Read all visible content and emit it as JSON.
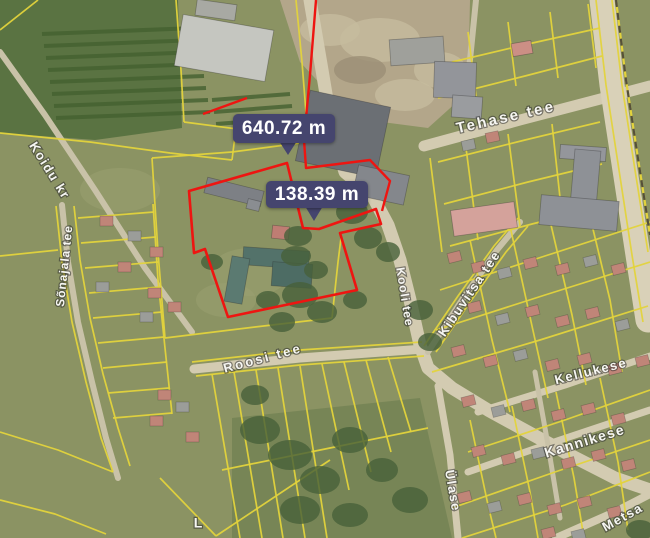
{
  "map": {
    "palette": {
      "base": "#8b9363",
      "fieldDark": "#5a7342",
      "fieldRow": "#446030",
      "dirt": "#b3a68a",
      "dirtLight": "#c6bb9d",
      "dirtDark": "#9b8f75",
      "woods": "#5f7647",
      "tree": "#47603a",
      "grassLight": "#9aa171",
      "road": "#d3cbb1",
      "roadMinor": "#c9c2a8",
      "highway": "#d9d1b8",
      "yellow": "#e3d33c",
      "dashDark": "#55503a",
      "red": "#ee1511",
      "badge": "#45456e",
      "salmon": "#c08578",
      "grayHouse": "#9b9d99"
    },
    "measurements": [
      {
        "label": "640.72 m",
        "x": 233,
        "y": 114,
        "w": 102,
        "h": 29,
        "tail": "279,141 297,141 288,155"
      },
      {
        "label": "138.39 m",
        "x": 266,
        "y": 181,
        "w": 102,
        "h": 27,
        "tail": "305,206 323,206 314,221"
      }
    ],
    "street_labels": [
      {
        "id": "tehase-tee",
        "text": "Tehase tee",
        "x": 506,
        "y": 118,
        "rotate": -13,
        "size": 15,
        "spacing": 2.5
      },
      {
        "id": "koidu-kr",
        "text": "Koidu kr",
        "x": 49,
        "y": 171,
        "rotate": 58,
        "size": 13,
        "spacing": 1.5
      },
      {
        "id": "sonajala-tee",
        "text": "Sõnajala tee",
        "x": 65,
        "y": 266,
        "rotate": -84,
        "size": 12,
        "spacing": 1
      },
      {
        "id": "roosi-tee",
        "text": "Roosi tee",
        "x": 263,
        "y": 359,
        "rotate": -15,
        "size": 13,
        "spacing": 2.5
      },
      {
        "id": "kooli-tee",
        "text": "Kooli tee",
        "x": 404,
        "y": 297,
        "rotate": 81,
        "size": 12,
        "spacing": 1
      },
      {
        "id": "kibuvitsa-tee",
        "text": "Kibuvitsa tee",
        "x": 470,
        "y": 294,
        "rotate": -56,
        "size": 13,
        "spacing": 1.5
      },
      {
        "id": "kellukese",
        "text": "Kellukese",
        "x": 591,
        "y": 372,
        "rotate": -14,
        "size": 13,
        "spacing": 1.5
      },
      {
        "id": "kannikese",
        "text": "Kannikese",
        "x": 585,
        "y": 442,
        "rotate": -17,
        "size": 14,
        "spacing": 1.5
      },
      {
        "id": "ulase",
        "text": "Ülase",
        "x": 452,
        "y": 491,
        "rotate": 80,
        "size": 13,
        "spacing": 1.5
      },
      {
        "id": "metsa",
        "text": "Metsa",
        "x": 623,
        "y": 518,
        "rotate": -29,
        "size": 13,
        "spacing": 1.5
      },
      {
        "id": "partial-l",
        "text": "L",
        "x": 198,
        "y": 524,
        "rotate": 0,
        "size": 14,
        "spacing": 0
      }
    ],
    "red_outline": {
      "polygon": "189,191 287,163 303,228 319,229 376,209 381,224 340,233 357,290 228,317 205,249 194,253",
      "lines": [
        "316,0 310,75 304,140 306,168 370,160 390,181 382,211",
        "203,114 247,98"
      ]
    },
    "terrain": {
      "field_polygon": "0,0 178,0 182,128 95,140 0,133",
      "field_rows": [
        "42,34 196,28",
        "44,46 198,40",
        "46,58 200,52",
        "48,70 202,64",
        "50,82 204,76",
        "52,94 206,88",
        "54,106 208,100",
        "56,118 210,112",
        "212,100 290,94",
        "214,112 292,106",
        "216,124 294,118"
      ],
      "dirt_polygon": "280,0 470,0 468,92 428,128 352,118 300,62",
      "dirt_blobs": [
        [
          380,
          40,
          40,
          22
        ],
        [
          330,
          30,
          30,
          16
        ],
        [
          440,
          70,
          26,
          18
        ],
        [
          405,
          95,
          30,
          16
        ]
      ],
      "dirt_dark_blobs": [
        [
          360,
          70,
          26,
          14
        ]
      ],
      "woods_polygon": "232,418 420,398 452,538 232,538",
      "grass_patches": [
        [
          250,
          272,
          40,
          24
        ],
        [
          226,
          300,
          30,
          17
        ],
        [
          120,
          190,
          40,
          22
        ]
      ],
      "trees": [
        [
          352,
          212,
          16,
          12
        ],
        [
          368,
          238,
          14,
          11
        ],
        [
          336,
          192,
          13,
          10
        ],
        [
          388,
          252,
          12,
          10
        ],
        [
          300,
          295,
          18,
          13
        ],
        [
          322,
          312,
          15,
          11
        ],
        [
          282,
          322,
          13,
          10
        ],
        [
          355,
          300,
          12,
          9
        ],
        [
          298,
          236,
          14,
          10
        ],
        [
          268,
          300,
          12,
          9
        ],
        [
          420,
          310,
          13,
          10
        ],
        [
          430,
          342,
          12,
          9
        ],
        [
          260,
          430,
          20,
          14
        ],
        [
          290,
          455,
          22,
          15
        ],
        [
          320,
          480,
          20,
          14
        ],
        [
          350,
          440,
          18,
          13
        ],
        [
          382,
          470,
          16,
          12
        ],
        [
          410,
          500,
          18,
          13
        ],
        [
          300,
          510,
          20,
          14
        ],
        [
          350,
          515,
          18,
          12
        ],
        [
          255,
          395,
          14,
          10
        ],
        [
          640,
          530,
          14,
          10
        ],
        [
          212,
          262,
          11,
          8
        ],
        [
          296,
          256,
          15,
          10
        ],
        [
          316,
          270,
          12,
          9
        ]
      ]
    },
    "roads": [
      {
        "pts": "310,0 322,70 332,130 345,172 372,195 388,225 400,260 410,300 420,345 428,368 452,388 488,410 528,432 570,455 615,478 650,490",
        "w": 13,
        "c": "road"
      },
      {
        "pts": "424,146 520,120 650,86",
        "w": 11,
        "c": "road"
      },
      {
        "pts": "194,369 300,358 424,349",
        "w": 9,
        "c": "road"
      },
      {
        "pts": "0,52 45,115 95,190 145,268 192,332",
        "w": 6,
        "c": "roadMinor"
      },
      {
        "pts": "62,205 68,262 78,322 92,382 106,438 118,478",
        "w": 6,
        "c": "roadMinor"
      },
      {
        "pts": "602,0 612,85 625,170 638,255 648,320",
        "w": 25,
        "c": "highway"
      },
      {
        "pts": "478,412 565,385 650,356",
        "w": 7,
        "c": "road"
      },
      {
        "pts": "468,472 560,440 650,410",
        "w": 7,
        "c": "road"
      },
      {
        "pts": "556,538 615,512 650,494",
        "w": 8,
        "c": "road"
      },
      {
        "pts": "438,386 450,455 458,538",
        "w": 7,
        "c": "road"
      },
      {
        "pts": "535,372 548,445 560,518",
        "w": 5,
        "c": "roadMinor"
      },
      {
        "pts": "428,352 462,300 497,250 520,222",
        "w": 6,
        "c": "roadMinor"
      },
      {
        "pts": "476,0 470,60 463,112",
        "w": 6,
        "c": "roadMinor"
      }
    ],
    "parcel_lines": [
      "0,30 38,0",
      "0,133 90,142 170,153 232,160",
      "176,0 181,70 184,122",
      "184,122 245,130 308,138",
      "296,0 302,62 308,138",
      "232,160 236,128",
      "152,158 158,252 165,338",
      "152,158 232,152",
      "232,152 300,143",
      "165,338 255,327 332,318",
      "332,318 338,262 341,238",
      "192,362 300,350 422,342",
      "196,376 300,365 424,356",
      "212,374 240,538",
      "234,372 262,538",
      "256,370 283,538",
      "278,368 305,538",
      "300,366 327,538",
      "322,364 349,490",
      "344,362 371,472",
      "366,360 391,452",
      "388,357 411,432",
      "222,470 330,448 428,428",
      "160,478 216,536",
      "216,536 330,460",
      "56,206 62,262 72,322 86,382 101,438 113,472",
      "74,206 80,260 90,318 103,374 118,428 130,466",
      "153,204 158,280 165,348 172,414",
      "78,218 154,212",
      "81,243 156,237",
      "85,268 158,262",
      "89,293 160,287",
      "93,318 162,312",
      "98,343 164,337",
      "103,368 167,362",
      "108,393 169,388",
      "113,418 172,413",
      "0,256 58,250",
      "0,432 58,450 113,472",
      "0,500 55,514 106,534",
      "452,62 528,44 600,28",
      "438,98 525,76 602,56",
      "468,32 476,96",
      "508,22 516,86",
      "550,12 558,78",
      "588,4 596,68",
      "438,162 525,140 600,122",
      "444,204 528,182 602,164",
      "450,246 532,224 604,206",
      "466,148 478,240",
      "508,134 520,226",
      "552,124 562,216",
      "430,158 442,252",
      "596,0 606,85 619,170 632,255 643,322",
      "612,0 622,85 635,170 648,252",
      "432,372 540,340 648,306",
      "436,330 545,295 650,262",
      "440,290 548,255 650,222",
      "468,452 565,420 650,390",
      "452,508 555,472 650,440",
      "462,538 565,505 650,472",
      "470,240 492,340 510,412",
      "510,226 532,326 548,398",
      "548,212 572,315 586,385",
      "586,200 610,300 622,372",
      "470,420 488,505 496,538",
      "512,406 530,492 538,538",
      "556,392 574,478 584,538",
      "600,378 618,462 628,530",
      "424,346 458,296 494,246 518,218",
      "436,352 470,302 506,252 528,226"
    ],
    "railway_dash": "616,0 626,80 639,165 650,235",
    "buildings": [
      {
        "x": 196,
        "y": 2,
        "w": 40,
        "h": 16,
        "r": 8,
        "f": "#a8a9a3"
      },
      {
        "x": 178,
        "y": 22,
        "w": 92,
        "h": 52,
        "r": 10,
        "f": "#c5c6c0"
      },
      {
        "x": 302,
        "y": 98,
        "w": 82,
        "h": 72,
        "r": 12,
        "f": "#6b6f74"
      },
      {
        "x": 355,
        "y": 170,
        "w": 52,
        "h": 30,
        "r": 12,
        "f": "#84878c"
      },
      {
        "x": 390,
        "y": 38,
        "w": 54,
        "h": 26,
        "r": -4,
        "f": "#9fa09b"
      },
      {
        "x": 434,
        "y": 62,
        "w": 42,
        "h": 36,
        "r": 2,
        "f": "#93959a"
      },
      {
        "x": 452,
        "y": 96,
        "w": 30,
        "h": 22,
        "r": 4,
        "f": "#9a9c9f"
      },
      {
        "x": 512,
        "y": 42,
        "w": 20,
        "h": 13,
        "r": -10,
        "f": "#cc8f85"
      },
      {
        "x": 560,
        "y": 146,
        "w": 46,
        "h": 14,
        "r": 4,
        "f": "#94969b"
      },
      {
        "x": 572,
        "y": 150,
        "w": 26,
        "h": 68,
        "r": 5,
        "f": "#8e9196"
      },
      {
        "x": 540,
        "y": 198,
        "w": 78,
        "h": 30,
        "r": 5,
        "f": "#8e9196"
      },
      {
        "x": 452,
        "y": 206,
        "w": 64,
        "h": 26,
        "r": -8,
        "f": "#d4a29b"
      },
      {
        "x": 205,
        "y": 184,
        "w": 58,
        "h": 16,
        "r": 14,
        "f": "#7d8085"
      },
      {
        "x": 247,
        "y": 200,
        "w": 13,
        "h": 10,
        "r": 14,
        "f": "#8a8d91"
      },
      {
        "x": 272,
        "y": 226,
        "w": 17,
        "h": 13,
        "r": 6,
        "f": "#bf7d73"
      },
      {
        "x": 243,
        "y": 249,
        "w": 66,
        "h": 18,
        "r": 4,
        "f": "#53726a"
      },
      {
        "x": 228,
        "y": 257,
        "w": 18,
        "h": 46,
        "r": 10,
        "f": "#5b7a71"
      },
      {
        "x": 272,
        "y": 263,
        "w": 40,
        "h": 24,
        "r": 4,
        "f": "#4d6c64"
      }
    ],
    "houses": [
      [
        100,
        216,
        0,
        "s"
      ],
      [
        128,
        231,
        0,
        "g"
      ],
      [
        150,
        247,
        0,
        "s"
      ],
      [
        118,
        262,
        0,
        "s"
      ],
      [
        96,
        282,
        0,
        "g"
      ],
      [
        148,
        288,
        0,
        "s"
      ],
      [
        168,
        302,
        0,
        "s"
      ],
      [
        140,
        312,
        0,
        "g"
      ],
      [
        158,
        390,
        0,
        "s"
      ],
      [
        176,
        402,
        0,
        "g"
      ],
      [
        150,
        416,
        0,
        "s"
      ],
      [
        186,
        432,
        0,
        "s"
      ],
      [
        448,
        252,
        -14,
        "s"
      ],
      [
        472,
        262,
        -14,
        "s"
      ],
      [
        498,
        268,
        -14,
        "g"
      ],
      [
        524,
        258,
        -14,
        "s"
      ],
      [
        556,
        264,
        -14,
        "s"
      ],
      [
        584,
        256,
        -14,
        "g"
      ],
      [
        612,
        264,
        -14,
        "s"
      ],
      [
        468,
        302,
        -14,
        "s"
      ],
      [
        496,
        314,
        -14,
        "g"
      ],
      [
        526,
        306,
        -14,
        "s"
      ],
      [
        556,
        316,
        -14,
        "s"
      ],
      [
        586,
        308,
        -14,
        "s"
      ],
      [
        616,
        320,
        -14,
        "g"
      ],
      [
        452,
        346,
        -14,
        "s"
      ],
      [
        484,
        356,
        -14,
        "s"
      ],
      [
        514,
        350,
        -14,
        "g"
      ],
      [
        546,
        360,
        -14,
        "s"
      ],
      [
        578,
        354,
        -14,
        "s"
      ],
      [
        608,
        364,
        -14,
        "s"
      ],
      [
        636,
        356,
        -14,
        "s"
      ],
      [
        462,
        396,
        -14,
        "s"
      ],
      [
        492,
        406,
        -14,
        "g"
      ],
      [
        522,
        400,
        -14,
        "s"
      ],
      [
        552,
        410,
        -14,
        "s"
      ],
      [
        582,
        404,
        -14,
        "s"
      ],
      [
        612,
        414,
        -14,
        "s"
      ],
      [
        472,
        446,
        -14,
        "s"
      ],
      [
        502,
        454,
        -14,
        "s"
      ],
      [
        532,
        448,
        -14,
        "g"
      ],
      [
        562,
        458,
        -14,
        "s"
      ],
      [
        592,
        450,
        -14,
        "s"
      ],
      [
        622,
        460,
        -14,
        "s"
      ],
      [
        458,
        492,
        -14,
        "s"
      ],
      [
        488,
        502,
        -14,
        "g"
      ],
      [
        518,
        494,
        -14,
        "s"
      ],
      [
        548,
        504,
        -14,
        "s"
      ],
      [
        578,
        497,
        -14,
        "s"
      ],
      [
        608,
        507,
        -14,
        "s"
      ],
      [
        542,
        528,
        -14,
        "s"
      ],
      [
        572,
        530,
        -14,
        "g"
      ],
      [
        462,
        140,
        -12,
        "g"
      ],
      [
        486,
        132,
        -12,
        "s"
      ]
    ]
  }
}
